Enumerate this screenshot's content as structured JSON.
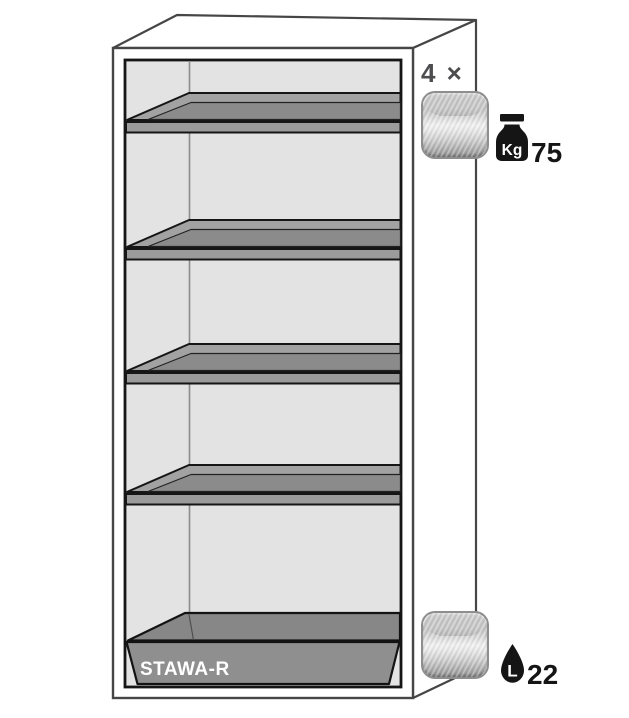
{
  "cabinet": {
    "sump_tray_label": "STAWA-R"
  },
  "callouts": {
    "shelves": {
      "count_label": "4 ×",
      "load_unit": "Kg",
      "load_value": "75"
    },
    "sump": {
      "volume_unit": "L",
      "volume_value": "22"
    }
  },
  "icons": {
    "shelf_thumbnail": "metallic-square-swatch",
    "tray_thumbnail": "metallic-square-swatch",
    "load": "kettlebell-weight-icon",
    "volume": "liquid-drop-icon"
  },
  "colors": {
    "cabinet_outline": "#464646",
    "frame_outline": "#161616",
    "interior_fill": "#e3e3e3",
    "shelf_rim_fill": "#a2a2a2",
    "shelf_floor_fill": "#8b8b8b",
    "shelf_front_fill": "#9b9b9b",
    "tray_top_fill": "#878787",
    "tray_front_fill": "#8f8f8f",
    "sump_label_text": "#ffffff",
    "count_text": "#4d4d4f",
    "value_text": "#151515",
    "metal_light": "#f1f1f1",
    "metal_dark": "#8f8f8f"
  }
}
